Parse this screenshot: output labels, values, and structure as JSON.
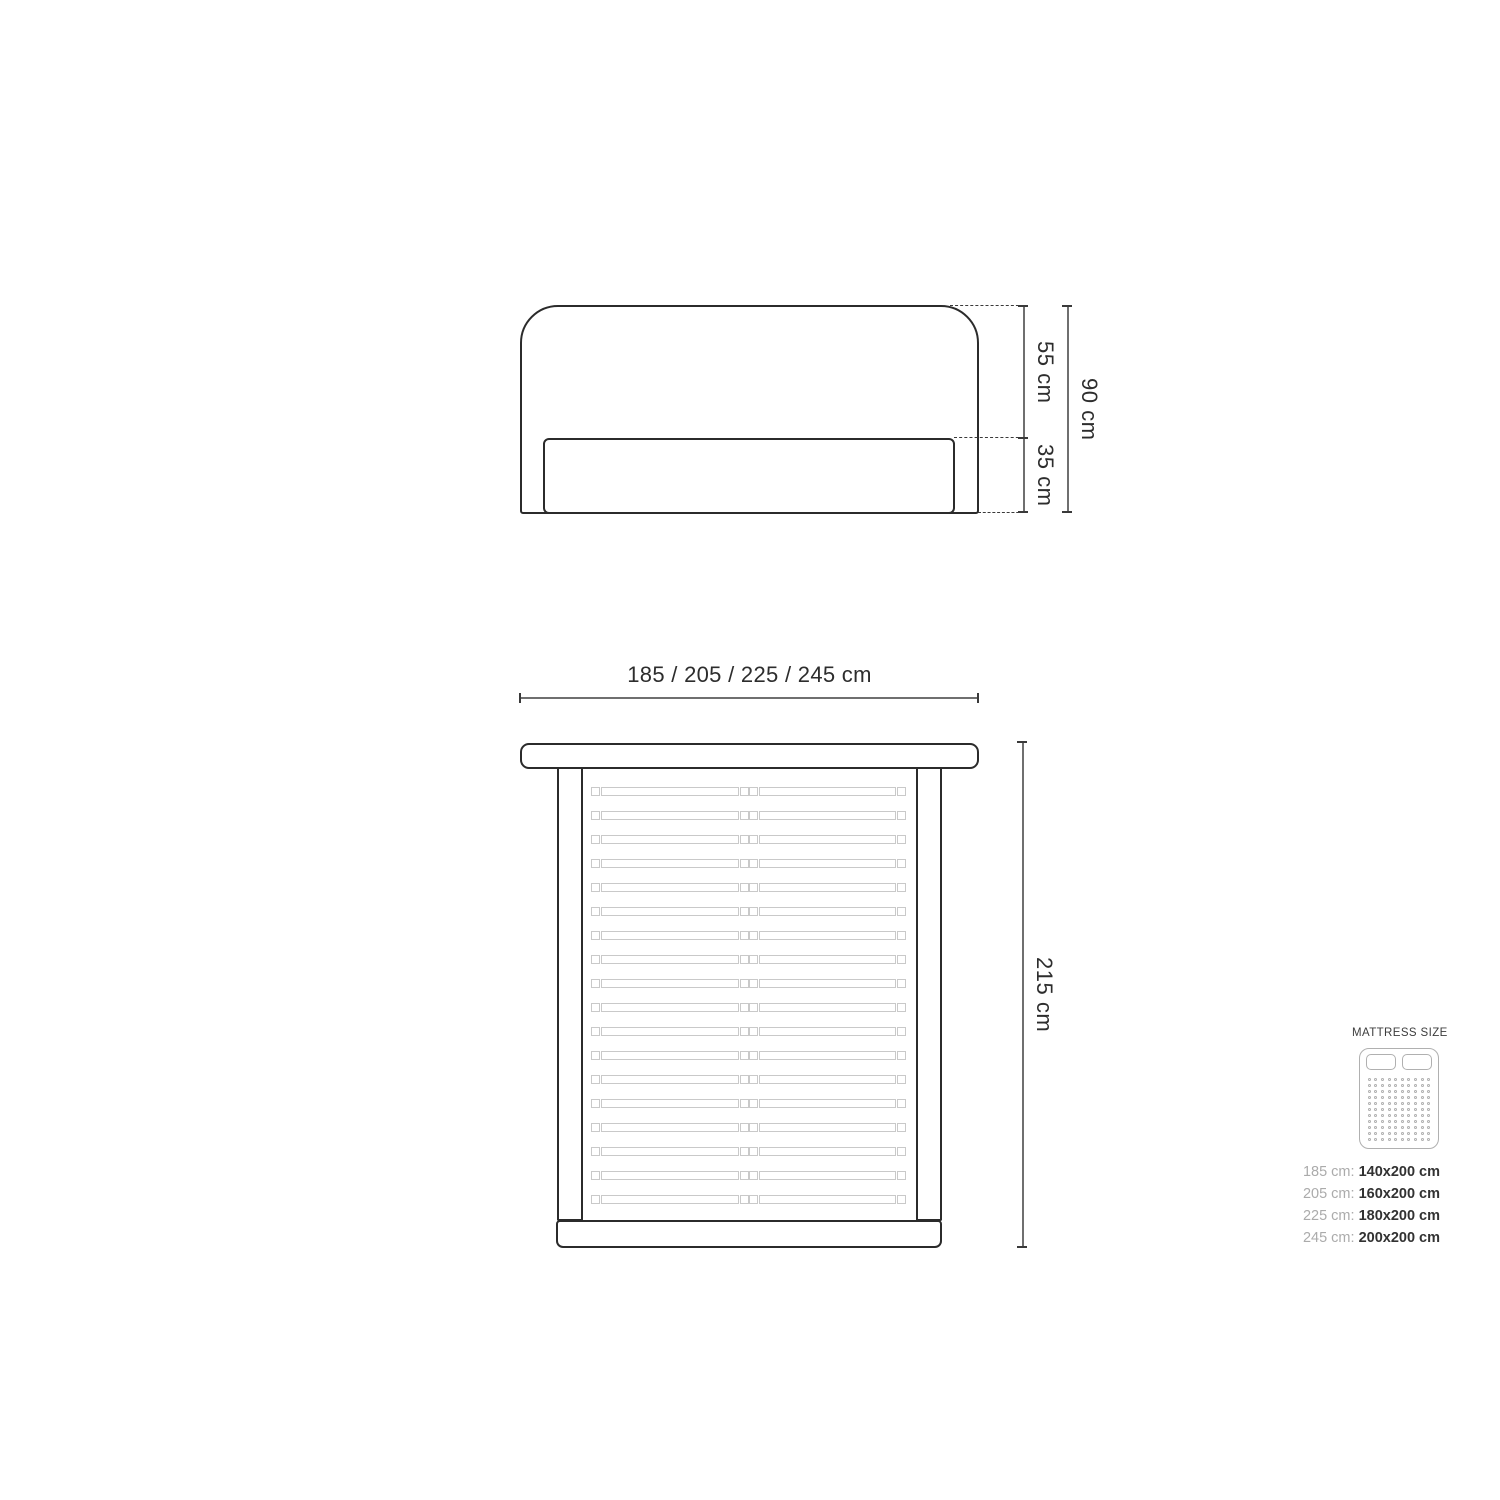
{
  "diagram": {
    "front_view": {
      "height_upper_label": "55 cm",
      "height_lower_label": "35 cm",
      "height_total_label": "90 cm"
    },
    "top_view": {
      "width_label": "185 / 205 / 225 / 245 cm",
      "length_label": "215 cm",
      "slat_count": 18
    },
    "legend": {
      "title": "MATTRESS SIZE",
      "sizes": [
        {
          "label": "185 cm:",
          "value": "140x200 cm"
        },
        {
          "label": "205 cm:",
          "value": "160x200 cm"
        },
        {
          "label": "225 cm:",
          "value": "180x200 cm"
        },
        {
          "label": "245 cm:",
          "value": "200x200 cm"
        }
      ],
      "icon": {
        "pillow_count": 2,
        "dot_cols": 10,
        "dot_rows": 11
      }
    },
    "colors": {
      "outline": "#2b2b2b",
      "slat": "#c9c9c9",
      "dimension_line": "#6f6f6f",
      "tick": "#3a3a3a",
      "dimension_text": "#2d2d2d",
      "legend_label": "#ababab",
      "legend_value": "#323232",
      "legend_icon": "#b0b0b0",
      "background": "#ffffff"
    }
  }
}
